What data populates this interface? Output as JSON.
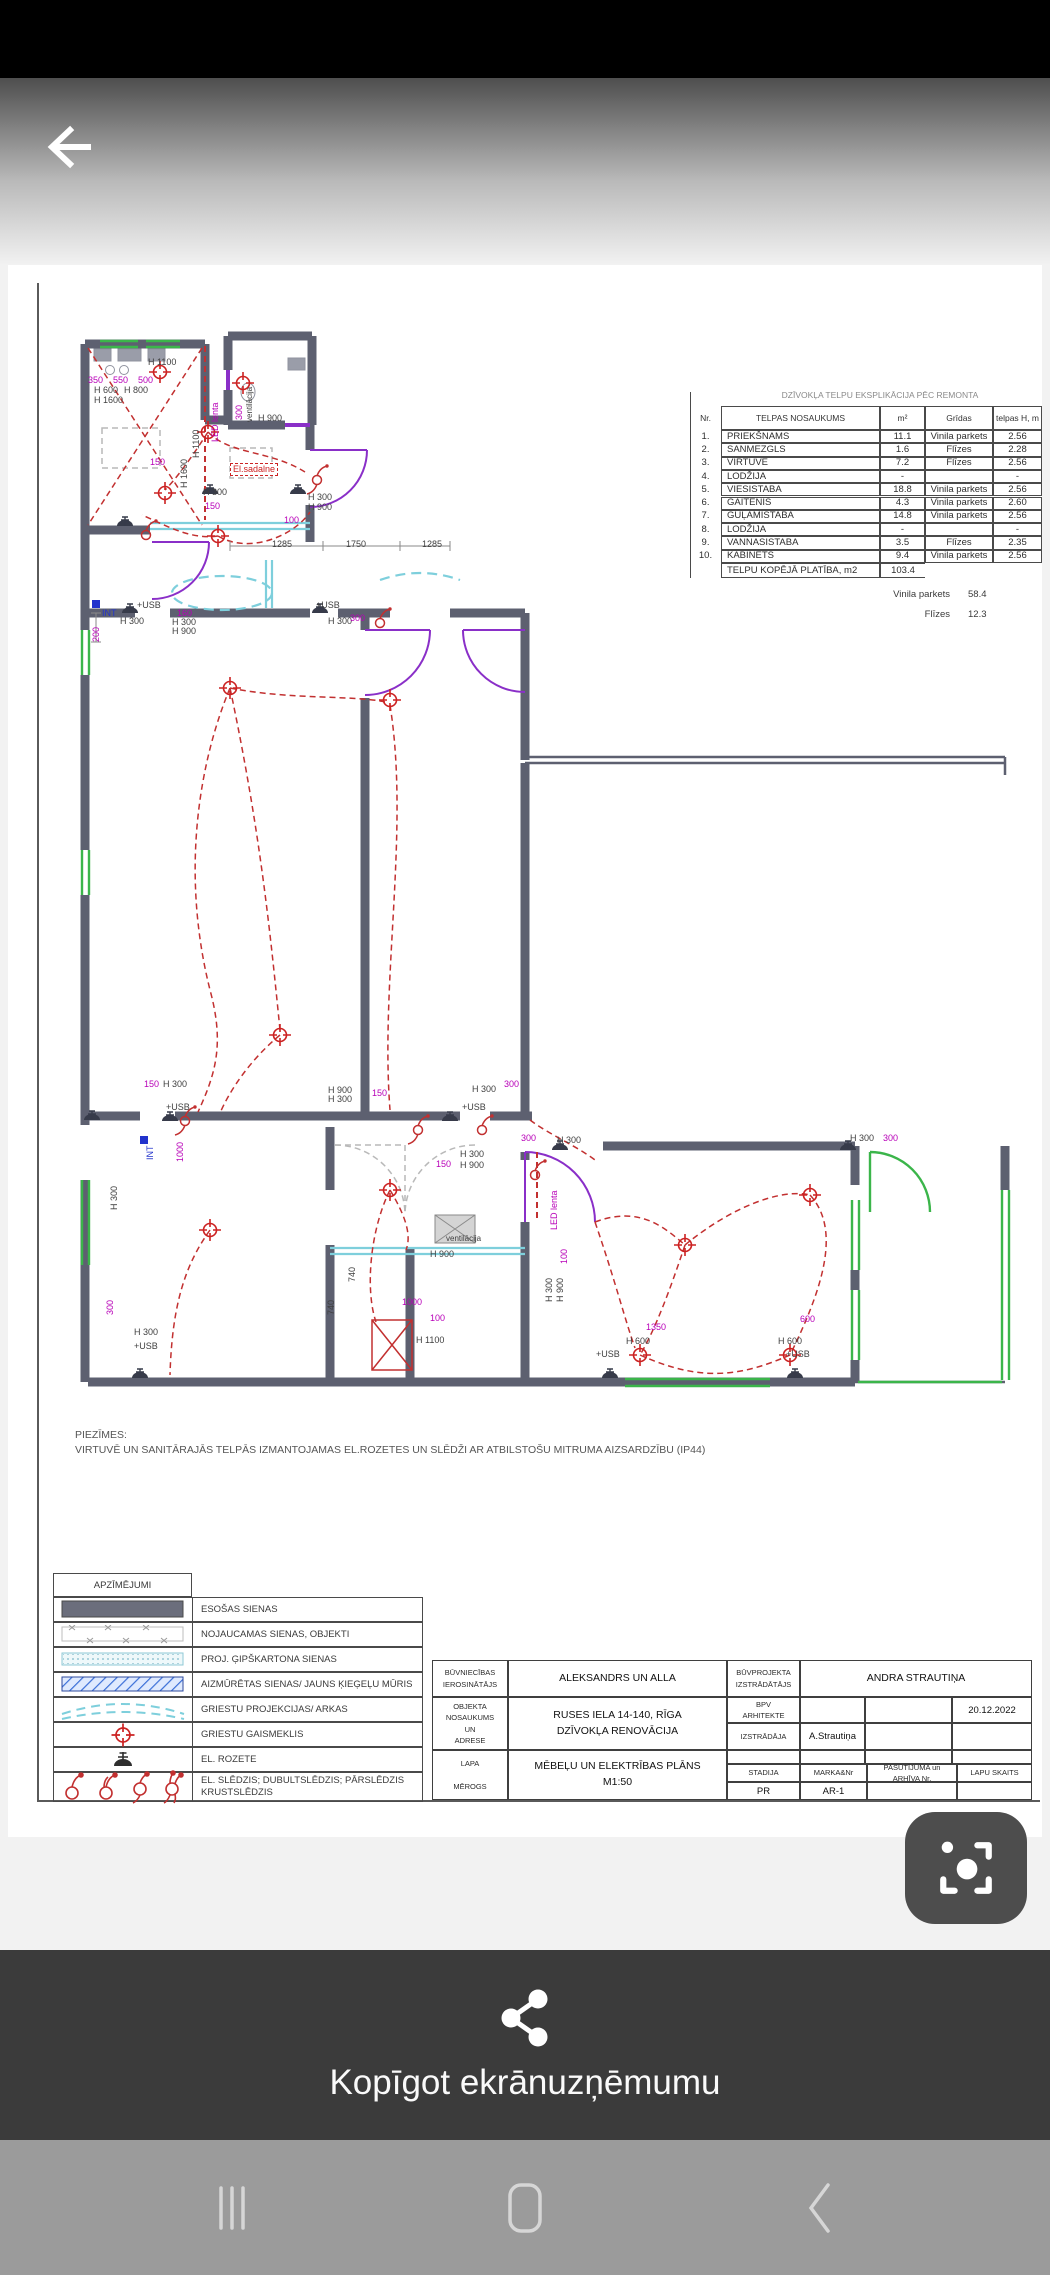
{
  "colors": {
    "wall": "#5d6070",
    "wire_red": "#c23030",
    "dim_magenta": "#b800b8",
    "cyan": "#7ecfdc",
    "green": "#3bb54a",
    "purple": "#8a2fc8",
    "share_bg": "#3b3b3b",
    "navbar_bg": "#9b9b9b",
    "scan_btn_bg": "#4d4d4d"
  },
  "document": {
    "explication_table": {
      "title": "DZĪVOKĻA TELPU EKSPLIKĀCIJA PĒC REMONTA",
      "headers": [
        "Nr.",
        "TELPAS NOSAUKUMS",
        "m²",
        "Grīdas",
        "telpas H,\nm"
      ],
      "rows": [
        [
          "1.",
          "PRIEKŠNAMS",
          "11.1",
          "Vinila parkets",
          "2.56"
        ],
        [
          "2.",
          "SANMEZGLS",
          "1.6",
          "Flīzes",
          "2.28"
        ],
        [
          "3.",
          "VIRTUVE",
          "7.2",
          "Flīzes",
          "2.56"
        ],
        [
          "4.",
          "LODŽIJA",
          "-",
          "",
          "-"
        ],
        [
          "5.",
          "VIESISTABA",
          "18.8",
          "Vinila parkets",
          "2.56"
        ],
        [
          "6.",
          "GAITENIS",
          "4.3",
          "Vinila parkets",
          "2.60"
        ],
        [
          "7.",
          "GUĻAMISTABA",
          "14.8",
          "Vinila parkets",
          "2.56"
        ],
        [
          "8.",
          "LODŽIJA",
          "-",
          "",
          "-"
        ],
        [
          "9.",
          "VANNASISTABA",
          "3.5",
          "Flīzes",
          "2.35"
        ],
        [
          "10.",
          "KABINETS",
          "9.4",
          "Vinila parkets",
          "2.56"
        ]
      ],
      "total_label": "TELPU KOPĒJĀ PLATĪBA, m2",
      "total_value": "103.4",
      "summary": [
        {
          "label": "Vinila parkets",
          "value": "58.4"
        },
        {
          "label": "Flīzes",
          "value": "12.3"
        }
      ]
    },
    "floor_plan": {
      "labels": [
        {
          "t": "H 1100",
          "x": 68,
          "y": 28,
          "c": "g"
        },
        {
          "t": "350",
          "x": 8,
          "y": 46,
          "c": "m"
        },
        {
          "t": "550",
          "x": 33,
          "y": 46,
          "c": "m"
        },
        {
          "t": "500",
          "x": 58,
          "y": 46,
          "c": "m"
        },
        {
          "t": "H 600",
          "x": 14,
          "y": 56,
          "c": "g"
        },
        {
          "t": "H 800",
          "x": 44,
          "y": 56,
          "c": "g"
        },
        {
          "t": "H 1600",
          "x": 14,
          "y": 66,
          "c": "g"
        },
        {
          "t": "LED lenta",
          "x": 131,
          "y": 112,
          "c": "m",
          "r": 1
        },
        {
          "t": "H 1100",
          "x": 112,
          "y": 128,
          "c": "g",
          "r": 1
        },
        {
          "t": "H 1600",
          "x": 100,
          "y": 158,
          "c": "g",
          "r": 1
        },
        {
          "t": "ventilācija",
          "x": 166,
          "y": 92,
          "c": "g",
          "r": 1,
          "s": 8
        },
        {
          "t": "300",
          "x": 155,
          "y": 90,
          "c": "m",
          "r": 1
        },
        {
          "t": "H 900",
          "x": 178,
          "y": 84,
          "c": "g"
        },
        {
          "t": "150",
          "x": 70,
          "y": 128,
          "c": "m"
        },
        {
          "t": "El.sadalne",
          "x": 150,
          "y": 133,
          "c": "r",
          "box": 1
        },
        {
          "t": "H 300",
          "x": 123,
          "y": 158,
          "c": "g"
        },
        {
          "t": "150",
          "x": 125,
          "y": 172,
          "c": "m"
        },
        {
          "t": "H 300",
          "x": 228,
          "y": 163,
          "c": "g"
        },
        {
          "t": "H 900",
          "x": 228,
          "y": 173,
          "c": "g"
        },
        {
          "t": "100",
          "x": 204,
          "y": 186,
          "c": "m"
        },
        {
          "t": "1285",
          "x": 192,
          "y": 210,
          "c": "g"
        },
        {
          "t": "1750",
          "x": 266,
          "y": 210,
          "c": "g"
        },
        {
          "t": "1285",
          "x": 342,
          "y": 210,
          "c": "g"
        },
        {
          "t": "+USB",
          "x": 57,
          "y": 271,
          "c": "g"
        },
        {
          "t": "INT",
          "x": 22,
          "y": 279,
          "c": "b"
        },
        {
          "t": "H 300",
          "x": 40,
          "y": 287,
          "c": "g"
        },
        {
          "t": "160",
          "x": 97,
          "y": 279,
          "c": "m"
        },
        {
          "t": "H 300",
          "x": 92,
          "y": 288,
          "c": "g"
        },
        {
          "t": "H 900",
          "x": 92,
          "y": 297,
          "c": "g"
        },
        {
          "t": "+USB",
          "x": 236,
          "y": 271,
          "c": "g"
        },
        {
          "t": "H 300",
          "x": 248,
          "y": 287,
          "c": "g"
        },
        {
          "t": "300",
          "x": 270,
          "y": 284,
          "c": "m"
        },
        {
          "t": "200",
          "x": 12,
          "y": 312,
          "c": "m",
          "r": 1
        },
        {
          "t": "150",
          "x": 64,
          "y": 750,
          "c": "m"
        },
        {
          "t": "H 300",
          "x": 83,
          "y": 750,
          "c": "g"
        },
        {
          "t": "+USB",
          "x": 86,
          "y": 773,
          "c": "g"
        },
        {
          "t": "H 900",
          "x": 248,
          "y": 756,
          "c": "g"
        },
        {
          "t": "H 300",
          "x": 248,
          "y": 765,
          "c": "g"
        },
        {
          "t": "150",
          "x": 292,
          "y": 759,
          "c": "m"
        },
        {
          "t": "H 300",
          "x": 392,
          "y": 755,
          "c": "g"
        },
        {
          "t": "300",
          "x": 424,
          "y": 750,
          "c": "m"
        },
        {
          "t": "+USB",
          "x": 382,
          "y": 773,
          "c": "g"
        },
        {
          "t": "300",
          "x": 441,
          "y": 804,
          "c": "m"
        },
        {
          "t": "H 300",
          "x": 477,
          "y": 806,
          "c": "g"
        },
        {
          "t": "H 300",
          "x": 770,
          "y": 804,
          "c": "g"
        },
        {
          "t": "300",
          "x": 803,
          "y": 804,
          "c": "m"
        },
        {
          "t": "LED lenta",
          "x": 470,
          "y": 900,
          "c": "m",
          "r": 1
        },
        {
          "t": "H 300",
          "x": 380,
          "y": 820,
          "c": "g"
        },
        {
          "t": "H 900",
          "x": 380,
          "y": 831,
          "c": "g"
        },
        {
          "t": "150",
          "x": 356,
          "y": 830,
          "c": "m"
        },
        {
          "t": "ventilācija",
          "x": 366,
          "y": 905,
          "c": "g",
          "s": 8
        },
        {
          "t": "H 900",
          "x": 350,
          "y": 920,
          "c": "g"
        },
        {
          "t": "740",
          "x": 268,
          "y": 952,
          "c": "g",
          "r": 1
        },
        {
          "t": "740",
          "x": 247,
          "y": 985,
          "c": "g",
          "r": 1
        },
        {
          "t": "1000",
          "x": 322,
          "y": 968,
          "c": "m"
        },
        {
          "t": "100",
          "x": 350,
          "y": 984,
          "c": "m"
        },
        {
          "t": "H 1100",
          "x": 336,
          "y": 1006,
          "c": "g"
        },
        {
          "t": "100",
          "x": 480,
          "y": 934,
          "c": "m",
          "r": 1
        },
        {
          "t": "H 300",
          "x": 465,
          "y": 972,
          "c": "g",
          "r": 1
        },
        {
          "t": "H 900",
          "x": 476,
          "y": 972,
          "c": "g",
          "r": 1
        },
        {
          "t": "1350",
          "x": 566,
          "y": 993,
          "c": "m"
        },
        {
          "t": "H 600",
          "x": 546,
          "y": 1007,
          "c": "g"
        },
        {
          "t": "H 600",
          "x": 698,
          "y": 1007,
          "c": "g"
        },
        {
          "t": "600",
          "x": 720,
          "y": 985,
          "c": "m"
        },
        {
          "t": "+USB",
          "x": 516,
          "y": 1020,
          "c": "g"
        },
        {
          "t": "+USB",
          "x": 706,
          "y": 1020,
          "c": "g"
        },
        {
          "t": "INT",
          "x": 66,
          "y": 830,
          "c": "b",
          "r": 1
        },
        {
          "t": "1000",
          "x": 96,
          "y": 832,
          "c": "m",
          "r": 1
        },
        {
          "t": "H 300",
          "x": 30,
          "y": 880,
          "c": "g",
          "r": 1
        },
        {
          "t": "300",
          "x": 26,
          "y": 985,
          "c": "m",
          "r": 1
        },
        {
          "t": "H 300",
          "x": 54,
          "y": 998,
          "c": "g"
        },
        {
          "t": "+USB",
          "x": 54,
          "y": 1012,
          "c": "g"
        }
      ]
    },
    "notes": {
      "title": "PIEZĪMES:",
      "line": "VIRTUVĒ UN SANITĀRAJĀS TELPĀS IZMANTOJAMAS EL.ROZETES UN SLĒDŽI  AR ATBILSTOŠU MITRUMA AIZSARDZĪBU (IP44)"
    },
    "legend": {
      "header": "APZĪMĒJUMI",
      "rows": [
        {
          "symbol": "existing-wall",
          "label": "ESOŠAS SIENAS"
        },
        {
          "symbol": "demolish-wall",
          "label": "NOJAUCAMAS SIENAS, OBJEKTI"
        },
        {
          "symbol": "gypsum-wall",
          "label": "PROJ. ĢIPŠKARTONA SIENAS"
        },
        {
          "symbol": "bricked-wall",
          "label": "AIZMŪRĒTAS SIENAS/ JAUNS ĶIEĢEĻU MŪRIS"
        },
        {
          "symbol": "ceiling-arc",
          "label": "GRIESTU PROJEKCIJAS/ ARKAS"
        },
        {
          "symbol": "ceiling-light",
          "label": "GRIESTU GAISMEKLIS"
        },
        {
          "symbol": "socket",
          "label": "EL. ROZETE"
        },
        {
          "symbol": "switches",
          "label": "EL. SLĒDZIS; DUBULTSLĒDZIS; PĀRSLĒDZIS\nKRUSTSLĒDZIS"
        }
      ]
    },
    "title_block": {
      "left": {
        "rows": [
          {
            "label": "BŪVNIECĪBAS\nIEROSINĀTĀJS",
            "value": "ALEKSANDRS UN ALLA"
          },
          {
            "label": "OBJEKTA\nNOSAUKUMS\nUN\nADRESE",
            "value": "RUSES IELA 14-140, RĪGA\nDZĪVOKĻA RENOVĀCIJA"
          },
          {
            "label": "LAPA\n\nMĒROGS",
            "value": "MĒBEĻU UN ELEKTRĪBAS PLĀNS\nM1:50"
          }
        ]
      },
      "right": {
        "designer_label": "BŪVPROJEKTA\nIZSTRĀDĀTĀJS",
        "designer_value": "ANDRA STRAUTIŅA",
        "rows": [
          {
            "label": "BPV\nARHITEKTE",
            "cells": [
              "",
              "",
              "20.12.2022"
            ]
          },
          {
            "label": "IZSTRĀDĀJA",
            "cells": [
              "A.Strautiņa",
              "",
              ""
            ]
          }
        ],
        "footer_headers": [
          "STADIJA",
          "MARKA&Nr",
          "PASŪTĪJUMA un\nARHĪVA Nr.",
          "LAPU SKAITS"
        ],
        "footer_values": [
          "PR",
          "AR-1",
          "",
          ""
        ]
      }
    }
  },
  "share_sheet": {
    "label": "Kopīgot ekrānuzņēmumu"
  },
  "android_nav": {
    "recents": "recents",
    "home": "home",
    "back": "back"
  }
}
